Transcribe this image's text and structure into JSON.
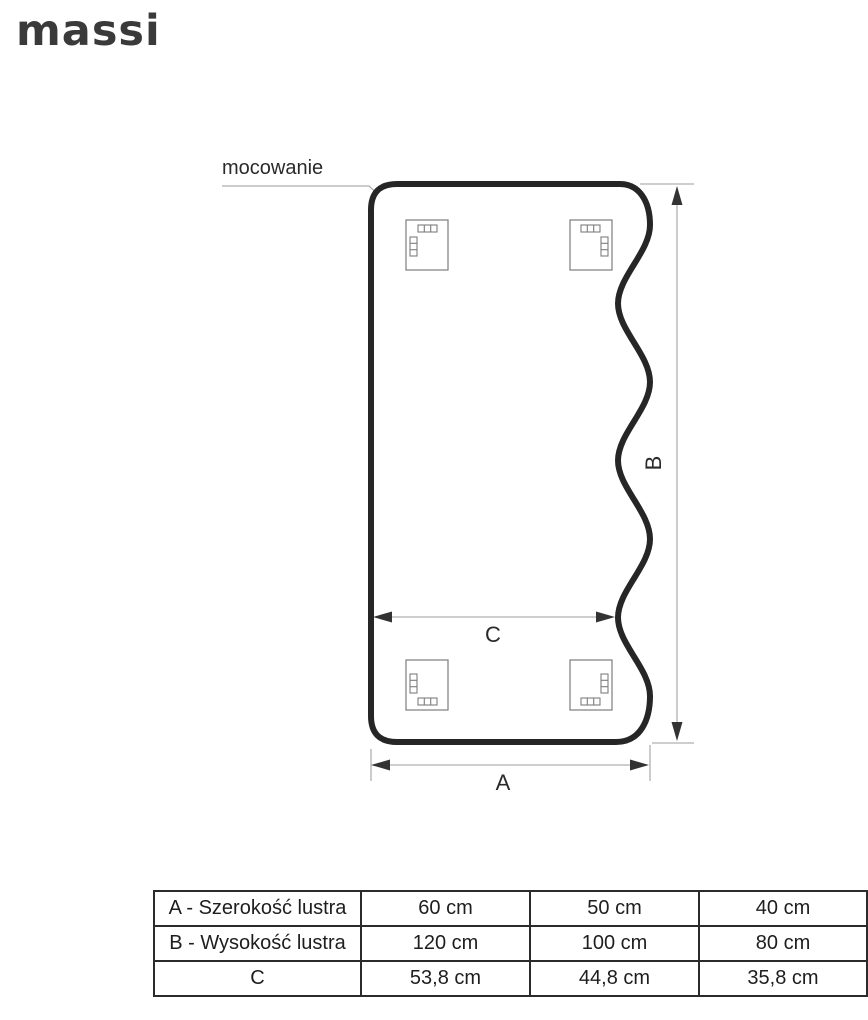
{
  "brand": {
    "name": "massi"
  },
  "diagram": {
    "mounting_label": "mocowanie",
    "width_label": "A",
    "height_label": "B",
    "inner_width_label": "C"
  },
  "table": {
    "rows": [
      {
        "label": "A - Szerokość lustra",
        "values": [
          "60 cm",
          "50 cm",
          "40 cm"
        ]
      },
      {
        "label": "B - Wysokość lustra",
        "values": [
          "120 cm",
          "100 cm",
          "80 cm"
        ]
      },
      {
        "label": "C",
        "values": [
          "53,8 cm",
          "44,8 cm",
          "35,8 cm"
        ]
      }
    ]
  },
  "colors": {
    "logo": "#3a3a3a",
    "mirror-stroke": "#262626",
    "dim-line": "#b0b0b0",
    "arrow": "#333333",
    "bracket-stroke": "#7d7d7d",
    "text": "#2a2a2a",
    "table-border": "#2b2b2b"
  }
}
